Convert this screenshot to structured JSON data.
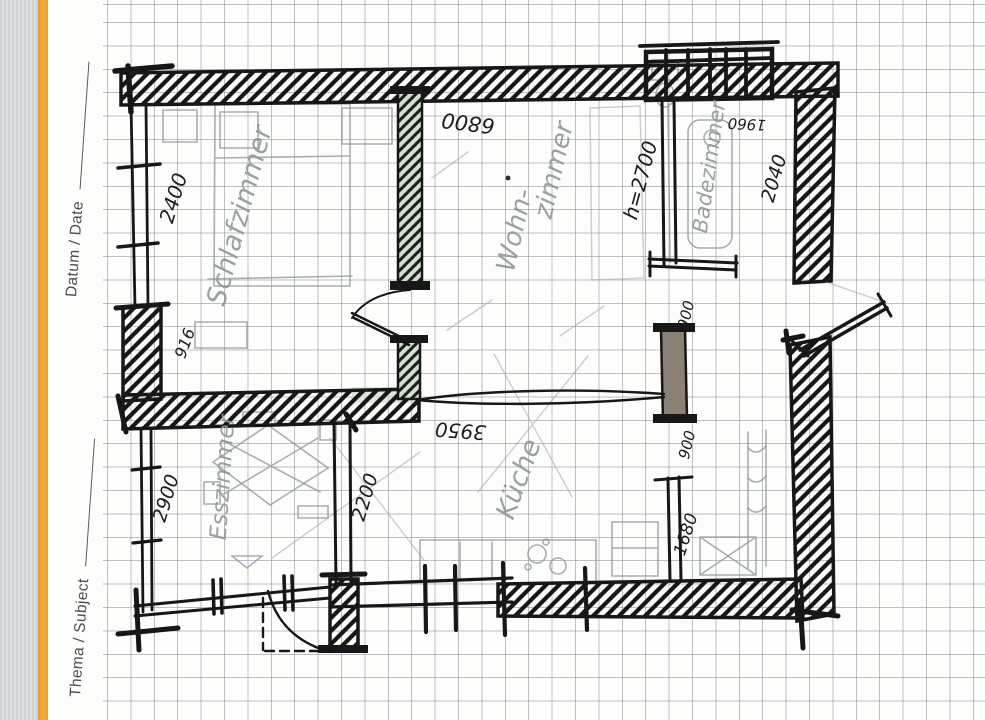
{
  "margin": {
    "datum_label": "Datum / Date",
    "thema_label": "Thema / Subject"
  },
  "labels": {
    "schlafzimmer": "Schlafzimmer",
    "wohn_line1": "Wohn-",
    "wohn_line2": "zimmer",
    "badezimmer": "Badezimmer",
    "kueche": "Küche",
    "esszimmer": "Esszimmer"
  },
  "dimensions": {
    "dim_2400": "2400",
    "dim_916": "916",
    "dim_6800": "6800",
    "height_note": "h=2700",
    "dim_1960": "1960",
    "dim_2040": "2040",
    "dim_900_upper": "900",
    "dim_900_lower": "900",
    "dim_3950": "3950",
    "dim_2900": "2900",
    "dim_2200": "2200",
    "dim_1680": "1680"
  },
  "colors": {
    "accent_orange": "#f0a73a",
    "grid_line": "#7a8494",
    "ink": "#171717",
    "pencil": "#939b9b",
    "green_wall": "#cfe0cc",
    "brown_pier": "#8b8076"
  }
}
